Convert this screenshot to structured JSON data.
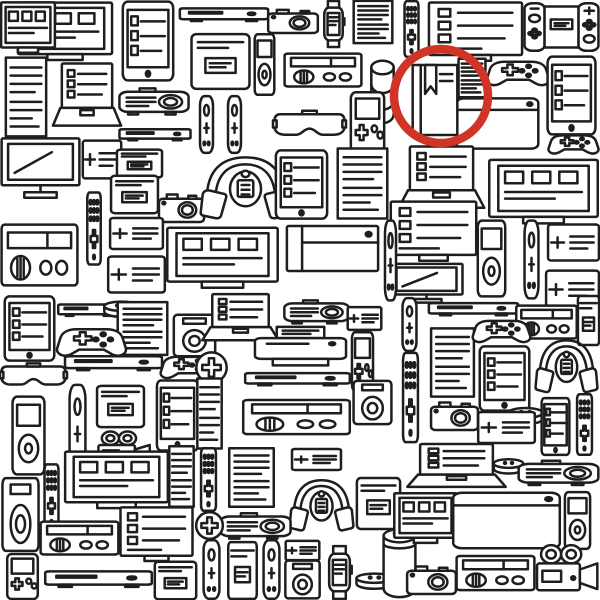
{
  "canvas": {
    "width": 600,
    "height": 600,
    "background": "#ffffff",
    "line_color": "#1f1e1c"
  },
  "highlight": {
    "shape": "circle",
    "cx": 441,
    "cy": 96,
    "r": 47,
    "color": "#cf3426",
    "stroke_width": 8.5,
    "circled_item": "book"
  },
  "found_object": {
    "type": "book",
    "description": "book with bookmark ribbon hidden among electronic gadgets"
  },
  "icon_legend": {
    "frame_boxes": "monitor-with-windows",
    "monitor_list": "monitor-with-checklist",
    "tablet_list": "tablet",
    "laptop_list": "laptop",
    "document": "document-page",
    "console_flat": "media-console",
    "camera": "photo-camera",
    "smartwatch": "smartwatch",
    "remote_dots": "remote-control",
    "switch_unit": "handheld-game-console",
    "phone_card": "card-device",
    "ipod": "music-player",
    "radio": "radio",
    "disc_stack": "disc-stack",
    "gamepad": "game-controller",
    "projector": "projector",
    "joycon_v": "controller-stick",
    "vr_headset": "vr-headset",
    "gameboy": "handheld-game",
    "blank_box": "device-box",
    "tv_stand": "tv-on-stand",
    "plus_card": "note-card",
    "headphones": "headphones-with-player",
    "ps4": "game-console-slab",
    "speaker_box": "speaker",
    "echo_dot": "smart-speaker-puck",
    "speaker_cyl": "smart-speaker",
    "printer": "printer",
    "plus_circle": "plus-badge",
    "video_camera": "video-camera",
    "book": "book-with-bookmark"
  },
  "icons": [
    {
      "t": "frame_boxes",
      "x": 16,
      "y": 0,
      "w": 98,
      "h": 66
    },
    {
      "t": "frame_boxes",
      "x": 0,
      "y": 0,
      "w": 56,
      "h": 58
    },
    {
      "t": "tablet_list",
      "x": 118,
      "y": 0,
      "w": 60,
      "h": 82
    },
    {
      "t": "console_flat",
      "x": 178,
      "y": 0,
      "w": 92,
      "h": 30
    },
    {
      "t": "camera",
      "x": 266,
      "y": 2,
      "w": 54,
      "h": 36
    },
    {
      "t": "smartwatch",
      "x": 317,
      "y": 0,
      "w": 33,
      "h": 48
    },
    {
      "t": "document",
      "x": 350,
      "y": 0,
      "w": 46,
      "h": 44
    },
    {
      "t": "remote_dots",
      "x": 397,
      "y": 0,
      "w": 29,
      "h": 58
    },
    {
      "t": "monitor_list",
      "x": 427,
      "y": 0,
      "w": 97,
      "h": 64
    },
    {
      "t": "switch_unit",
      "x": 523,
      "y": 0,
      "w": 77,
      "h": 54
    },
    {
      "t": "document",
      "x": 2,
      "y": 56,
      "w": 48,
      "h": 82
    },
    {
      "t": "laptop_list",
      "x": 50,
      "y": 62,
      "w": 74,
      "h": 74
    },
    {
      "t": "phone_card",
      "x": 189,
      "y": 33,
      "w": 63,
      "h": 57
    },
    {
      "t": "ipod",
      "x": 247,
      "y": 33,
      "w": 35,
      "h": 63
    },
    {
      "t": "radio",
      "x": 283,
      "y": 43,
      "w": 80,
      "h": 53
    },
    {
      "t": "disc_stack",
      "x": 365,
      "y": 57,
      "w": 35,
      "h": 75
    },
    {
      "t": "document",
      "x": 456,
      "y": 58,
      "w": 32,
      "h": 40
    },
    {
      "t": "gamepad",
      "x": 485,
      "y": 51,
      "w": 66,
      "h": 45
    },
    {
      "t": "tablet_list",
      "x": 543,
      "y": 55,
      "w": 57,
      "h": 81
    },
    {
      "t": "projector",
      "x": 118,
      "y": 80,
      "w": 72,
      "h": 42
    },
    {
      "t": "console_flat",
      "x": 118,
      "y": 122,
      "w": 74,
      "h": 26
    },
    {
      "t": "joycon_v",
      "x": 193,
      "y": 95,
      "w": 27,
      "h": 59
    },
    {
      "t": "joycon_v",
      "x": 221,
      "y": 95,
      "w": 27,
      "h": 59
    },
    {
      "t": "vr_headset",
      "x": 273,
      "y": 99,
      "w": 73,
      "h": 51
    },
    {
      "t": "gameboy",
      "x": 343,
      "y": 91,
      "w": 49,
      "h": 63
    },
    {
      "t": "blank_box",
      "x": 455,
      "y": 95,
      "w": 85,
      "h": 57
    },
    {
      "t": "gamepad",
      "x": 547,
      "y": 127,
      "w": 53,
      "h": 35
    },
    {
      "t": "tv_stand",
      "x": 0,
      "y": 137,
      "w": 81,
      "h": 69
    },
    {
      "t": "plus_card",
      "x": 82,
      "y": 137,
      "w": 40,
      "h": 45
    },
    {
      "t": "phone_card",
      "x": 115,
      "y": 149,
      "w": 49,
      "h": 29
    },
    {
      "t": "camera",
      "x": 157,
      "y": 185,
      "w": 49,
      "h": 43
    },
    {
      "t": "headphones",
      "x": 197,
      "y": 151,
      "w": 97,
      "h": 79
    },
    {
      "t": "tablet_list",
      "x": 271,
      "y": 149,
      "w": 61,
      "h": 71
    },
    {
      "t": "document",
      "x": 333,
      "y": 147,
      "w": 59,
      "h": 73
    },
    {
      "t": "laptop_list",
      "x": 395,
      "y": 145,
      "w": 93,
      "h": 73
    },
    {
      "t": "frame_boxes",
      "x": 487,
      "y": 157,
      "w": 113,
      "h": 73
    },
    {
      "t": "radio",
      "x": 0,
      "y": 205,
      "w": 79,
      "h": 98
    },
    {
      "t": "remote_dots",
      "x": 80,
      "y": 191,
      "w": 28,
      "h": 75
    },
    {
      "t": "phone_card",
      "x": 109,
      "y": 175,
      "w": 51,
      "h": 39
    },
    {
      "t": "plus_card",
      "x": 109,
      "y": 215,
      "w": 55,
      "h": 37
    },
    {
      "t": "plus_card",
      "x": 107,
      "y": 253,
      "w": 59,
      "h": 43
    },
    {
      "t": "frame_boxes",
      "x": 165,
      "y": 225,
      "w": 115,
      "h": 69
    },
    {
      "t": "ps4",
      "x": 285,
      "y": 211,
      "w": 95,
      "h": 75
    },
    {
      "t": "monitor_list",
      "x": 389,
      "y": 199,
      "w": 89,
      "h": 65
    },
    {
      "t": "tv_stand",
      "x": 389,
      "y": 263,
      "w": 75,
      "h": 45
    },
    {
      "t": "ipod",
      "x": 467,
      "y": 219,
      "w": 49,
      "h": 79
    },
    {
      "t": "joycon_v",
      "x": 517,
      "y": 219,
      "w": 29,
      "h": 81
    },
    {
      "t": "plus_card",
      "x": 547,
      "y": 221,
      "w": 53,
      "h": 43
    },
    {
      "t": "plus_card",
      "x": 545,
      "y": 267,
      "w": 55,
      "h": 45
    },
    {
      "t": "joycon_v",
      "x": 379,
      "y": 219,
      "w": 23,
      "h": 83
    },
    {
      "t": "tablet_list",
      "x": 0,
      "y": 295,
      "w": 59,
      "h": 67
    },
    {
      "t": "console_flat",
      "x": 57,
      "y": 297,
      "w": 63,
      "h": 27
    },
    {
      "t": "echo_dot",
      "x": 101,
      "y": 295,
      "w": 41,
      "h": 33
    },
    {
      "t": "document",
      "x": 113,
      "y": 301,
      "w": 59,
      "h": 55
    },
    {
      "t": "speaker_box",
      "x": 171,
      "y": 313,
      "w": 47,
      "h": 45
    },
    {
      "t": "gamepad",
      "x": 55,
      "y": 317,
      "w": 73,
      "h": 51
    },
    {
      "t": "vr_headset",
      "x": 0,
      "y": 353,
      "w": 67,
      "h": 45
    },
    {
      "t": "console_flat",
      "x": 63,
      "y": 347,
      "w": 101,
      "h": 33
    },
    {
      "t": "gamepad",
      "x": 159,
      "y": 347,
      "w": 59,
      "h": 41
    },
    {
      "t": "laptop_list",
      "x": 199,
      "y": 293,
      "w": 83,
      "h": 55
    },
    {
      "t": "projector",
      "x": 283,
      "y": 293,
      "w": 67,
      "h": 37
    },
    {
      "t": "plus_card",
      "x": 347,
      "y": 305,
      "w": 35,
      "h": 27
    },
    {
      "t": "console_flat",
      "x": 427,
      "y": 295,
      "w": 93,
      "h": 29
    },
    {
      "t": "joycon_v",
      "x": 395,
      "y": 297,
      "w": 29,
      "h": 55
    },
    {
      "t": "radio",
      "x": 515,
      "y": 295,
      "w": 63,
      "h": 53
    },
    {
      "t": "phone_card",
      "x": 577,
      "y": 295,
      "w": 23,
      "h": 51
    },
    {
      "t": "printer",
      "x": 251,
      "y": 325,
      "w": 99,
      "h": 47
    },
    {
      "t": "gameboy",
      "x": 347,
      "y": 331,
      "w": 31,
      "h": 61
    },
    {
      "t": "document",
      "x": 427,
      "y": 327,
      "w": 51,
      "h": 71
    },
    {
      "t": "gamepad",
      "x": 471,
      "y": 311,
      "w": 61,
      "h": 41
    },
    {
      "t": "tablet_list",
      "x": 475,
      "y": 345,
      "w": 59,
      "h": 67
    },
    {
      "t": "headphones",
      "x": 533,
      "y": 335,
      "w": 67,
      "h": 67
    },
    {
      "t": "plus_circle",
      "x": 195,
      "y": 351,
      "w": 33,
      "h": 33
    },
    {
      "t": "tablet_list",
      "x": 153,
      "y": 379,
      "w": 49,
      "h": 73
    },
    {
      "t": "console_flat",
      "x": 243,
      "y": 365,
      "w": 109,
      "h": 29
    },
    {
      "t": "radio",
      "x": 241,
      "y": 389,
      "w": 111,
      "h": 55
    },
    {
      "t": "document",
      "x": 195,
      "y": 377,
      "w": 29,
      "h": 73
    },
    {
      "t": "speaker_box",
      "x": 351,
      "y": 379,
      "w": 43,
      "h": 47
    },
    {
      "t": "remote_dots",
      "x": 395,
      "y": 351,
      "w": 31,
      "h": 93
    },
    {
      "t": "ipod",
      "x": 0,
      "y": 395,
      "w": 57,
      "h": 81
    },
    {
      "t": "joycon_v",
      "x": 61,
      "y": 383,
      "w": 33,
      "h": 91
    },
    {
      "t": "phone_card",
      "x": 95,
      "y": 385,
      "w": 51,
      "h": 43
    },
    {
      "t": "video_camera",
      "x": 95,
      "y": 427,
      "w": 57,
      "h": 45
    },
    {
      "t": "camera",
      "x": 429,
      "y": 393,
      "w": 51,
      "h": 43
    },
    {
      "t": "echo_dot",
      "x": 505,
      "y": 401,
      "w": 41,
      "h": 35
    },
    {
      "t": "tablet_list",
      "x": 539,
      "y": 397,
      "w": 33,
      "h": 59
    },
    {
      "t": "remote_dots",
      "x": 569,
      "y": 393,
      "w": 31,
      "h": 63
    },
    {
      "t": "plus_card",
      "x": 477,
      "y": 409,
      "w": 59,
      "h": 37
    },
    {
      "t": "document",
      "x": 167,
      "y": 445,
      "w": 29,
      "h": 63
    },
    {
      "t": "remote_dots",
      "x": 193,
      "y": 447,
      "w": 31,
      "h": 65
    },
    {
      "t": "document",
      "x": 225,
      "y": 447,
      "w": 53,
      "h": 61
    },
    {
      "t": "plus_card",
      "x": 291,
      "y": 447,
      "w": 51,
      "h": 25
    },
    {
      "t": "frame_boxes",
      "x": 63,
      "y": 449,
      "w": 107,
      "h": 65
    },
    {
      "t": "remote_dots",
      "x": 37,
      "y": 463,
      "w": 29,
      "h": 67
    },
    {
      "t": "speaker_box",
      "x": 0,
      "y": 475,
      "w": 41,
      "h": 79
    },
    {
      "t": "radio",
      "x": 39,
      "y": 511,
      "w": 81,
      "h": 53
    },
    {
      "t": "monitor_list",
      "x": 119,
      "y": 505,
      "w": 75,
      "h": 59
    },
    {
      "t": "gameboy",
      "x": 0,
      "y": 553,
      "w": 45,
      "h": 47
    },
    {
      "t": "console_flat",
      "x": 43,
      "y": 561,
      "w": 111,
      "h": 37
    },
    {
      "t": "phone_card",
      "x": 153,
      "y": 561,
      "w": 45,
      "h": 39
    },
    {
      "t": "headphones",
      "x": 287,
      "y": 475,
      "w": 69,
      "h": 65
    },
    {
      "t": "phone_card",
      "x": 355,
      "y": 477,
      "w": 47,
      "h": 53
    },
    {
      "t": "projector",
      "x": 219,
      "y": 505,
      "w": 73,
      "h": 41
    },
    {
      "t": "plus_circle",
      "x": 195,
      "y": 511,
      "w": 29,
      "h": 29
    },
    {
      "t": "joycon_v",
      "x": 195,
      "y": 539,
      "w": 33,
      "h": 61
    },
    {
      "t": "phone_card",
      "x": 227,
      "y": 541,
      "w": 31,
      "h": 59
    },
    {
      "t": "joycon_v",
      "x": 255,
      "y": 539,
      "w": 33,
      "h": 61
    },
    {
      "t": "plus_card",
      "x": 285,
      "y": 539,
      "w": 35,
      "h": 23
    },
    {
      "t": "speaker_box",
      "x": 283,
      "y": 559,
      "w": 39,
      "h": 41
    },
    {
      "t": "smartwatch",
      "x": 321,
      "y": 545,
      "w": 37,
      "h": 55
    },
    {
      "t": "echo_dot",
      "x": 353,
      "y": 567,
      "w": 43,
      "h": 33
    },
    {
      "t": "speaker_cyl",
      "x": 373,
      "y": 527,
      "w": 53,
      "h": 73
    },
    {
      "t": "laptop_list",
      "x": 403,
      "y": 443,
      "w": 107,
      "h": 51
    },
    {
      "t": "echo_dot",
      "x": 491,
      "y": 453,
      "w": 35,
      "h": 31
    },
    {
      "t": "projector",
      "x": 517,
      "y": 453,
      "w": 83,
      "h": 39
    },
    {
      "t": "frame_boxes",
      "x": 393,
      "y": 491,
      "w": 65,
      "h": 57
    },
    {
      "t": "blank_box",
      "x": 451,
      "y": 489,
      "w": 111,
      "h": 63
    },
    {
      "t": "ipod",
      "x": 555,
      "y": 491,
      "w": 45,
      "h": 59
    },
    {
      "t": "camera",
      "x": 405,
      "y": 557,
      "w": 53,
      "h": 43
    },
    {
      "t": "radio",
      "x": 455,
      "y": 545,
      "w": 81,
      "h": 55
    },
    {
      "t": "video_camera",
      "x": 533,
      "y": 539,
      "w": 67,
      "h": 61
    },
    {
      "t": "book",
      "x": 404,
      "y": 62,
      "w": 62,
      "h": 76
    }
  ]
}
